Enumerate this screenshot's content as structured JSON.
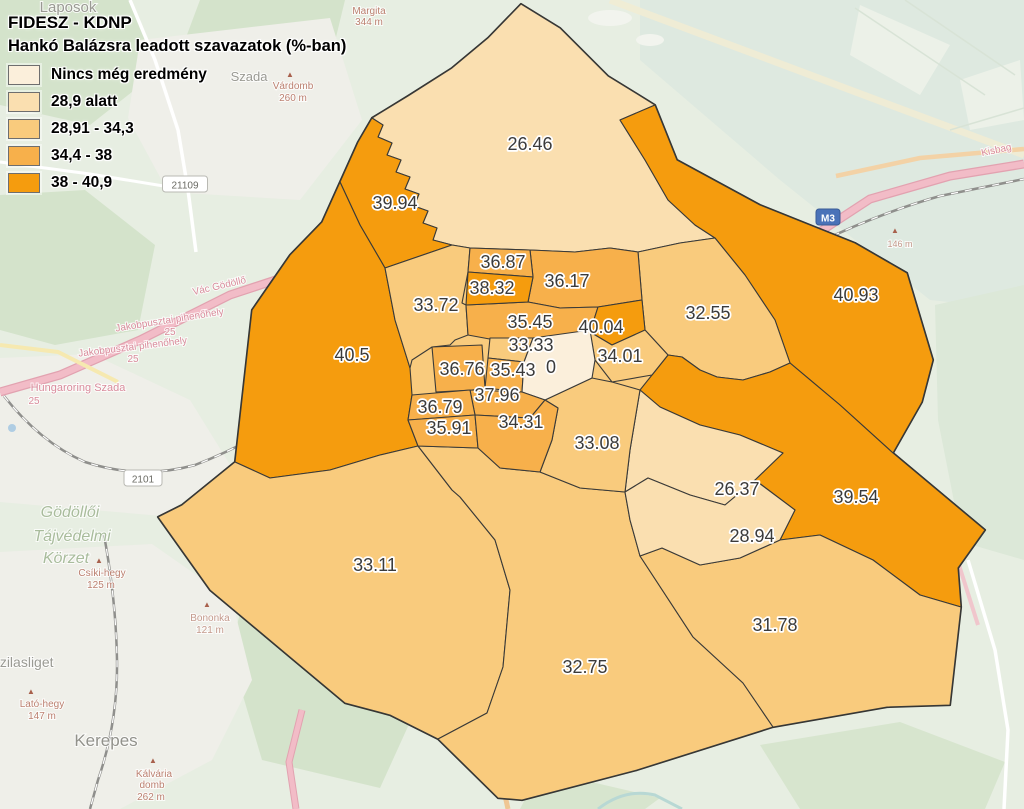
{
  "title": {
    "line1": "FIDESZ - KDNP",
    "line2": "Hankó Balázsra leadott szavazatok (%-ban)"
  },
  "legend": {
    "classes": [
      {
        "label": "Nincs még eredmény",
        "color": "#FBEFDB"
      },
      {
        "label": "28,9 alatt",
        "color": "#FADFB0"
      },
      {
        "label": "28,91 - 34,3",
        "color": "#F9CB7D"
      },
      {
        "label": "34,4 - 38",
        "color": "#F7B04B"
      },
      {
        "label": "38 - 40,9",
        "color": "#F59C0E"
      }
    ]
  },
  "map": {
    "border_color": "#3a3a38",
    "outline_color": "#2e2e2c",
    "districts": [
      {
        "value": "26.46",
        "class": 2,
        "x": 530,
        "y": 144
      },
      {
        "value": "40.93",
        "class": 5,
        "x": 856,
        "y": 295
      },
      {
        "value": "39.94",
        "class": 5,
        "x": 395,
        "y": 203
      },
      {
        "value": "40.5",
        "class": 5,
        "x": 352,
        "y": 355
      },
      {
        "value": "32.55",
        "class": 3,
        "x": 708,
        "y": 313
      },
      {
        "value": "33.72",
        "class": 3,
        "x": 436,
        "y": 305
      },
      {
        "value": "39.54",
        "class": 5,
        "x": 856,
        "y": 497
      },
      {
        "value": "33.11",
        "class": 3,
        "x": 375,
        "y": 565
      },
      {
        "value": "32.75",
        "class": 3,
        "x": 585,
        "y": 667
      },
      {
        "value": "31.78",
        "class": 3,
        "x": 775,
        "y": 625
      },
      {
        "value": "26.37",
        "class": 2,
        "x": 737,
        "y": 489
      },
      {
        "value": "28.94",
        "class": 2,
        "x": 752,
        "y": 536
      },
      {
        "value": "33.08",
        "class": 3,
        "x": 597,
        "y": 443
      },
      {
        "value": "36.17",
        "class": 4,
        "x": 567,
        "y": 281
      },
      {
        "value": "35.45",
        "class": 4,
        "x": 530,
        "y": 322
      },
      {
        "value": "36.87",
        "class": 4,
        "x": 503,
        "y": 262
      },
      {
        "value": "38.32",
        "class": 5,
        "x": 492,
        "y": 288
      },
      {
        "value": "40.04",
        "class": 5,
        "x": 601,
        "y": 327
      },
      {
        "value": "34.01",
        "class": 3,
        "x": 620,
        "y": 356
      },
      {
        "value": "33.33",
        "class": 3,
        "x": 531,
        "y": 345
      },
      {
        "value": "36.76",
        "class": 4,
        "x": 462,
        "y": 369
      },
      {
        "value": "35.43",
        "class": 4,
        "x": 513,
        "y": 370
      },
      {
        "value": "0",
        "class": 1,
        "x": 551,
        "y": 367
      },
      {
        "value": "37.96",
        "class": 4,
        "x": 497,
        "y": 395
      },
      {
        "value": "36.79",
        "class": 4,
        "x": 440,
        "y": 407
      },
      {
        "value": "35.91",
        "class": 4,
        "x": 449,
        "y": 428
      },
      {
        "value": "34.31",
        "class": 4,
        "x": 521,
        "y": 422
      }
    ]
  },
  "basemap": {
    "labels": [
      {
        "text": "Laposok",
        "x": 68,
        "y": 12,
        "size": 15,
        "color": "#9A9A93"
      },
      {
        "text": "Margita",
        "x": 369,
        "y": 14,
        "size": 10,
        "color": "#BC8070"
      },
      {
        "text": "344 m",
        "x": 369,
        "y": 25,
        "size": 10,
        "color": "#BC8070"
      },
      {
        "text": "Szada",
        "x": 249,
        "y": 81,
        "size": 13,
        "color": "#9A9A93"
      },
      {
        "text": "Várdomb",
        "x": 293,
        "y": 89,
        "size": 10,
        "color": "#BC8070"
      },
      {
        "text": "260 m",
        "x": 293,
        "y": 101,
        "size": 10,
        "color": "#BC8070"
      },
      {
        "text": "Vác Gödöllő",
        "x": 220,
        "y": 289,
        "size": 10,
        "color": "#D98C9C",
        "rot": -13
      },
      {
        "text": "Jakobpusztai pihenőhely",
        "x": 170,
        "y": 323,
        "size": 10,
        "color": "#D98C9C",
        "rot": -9
      },
      {
        "text": "25",
        "x": 170,
        "y": 335,
        "size": 10,
        "color": "#D98C9C"
      },
      {
        "text": "Jakobpusztai pihenőhely",
        "x": 133,
        "y": 350,
        "size": 10,
        "color": "#D98C9C",
        "rot": -7
      },
      {
        "text": "25",
        "x": 133,
        "y": 362,
        "size": 10,
        "color": "#D98C9C"
      },
      {
        "text": "Hungaroring Szada",
        "x": 78,
        "y": 391,
        "size": 11,
        "color": "#D98C9C"
      },
      {
        "text": "25",
        "x": 34,
        "y": 404,
        "size": 10,
        "color": "#D98C9C"
      },
      {
        "text": "Gödöllői",
        "x": 70,
        "y": 517,
        "size": 16,
        "color": "#A9BC9C",
        "italic": true
      },
      {
        "text": "Tájvédelmi",
        "x": 72,
        "y": 541,
        "size": 16,
        "color": "#A9BC9C",
        "italic": true
      },
      {
        "text": "Körzet",
        "x": 66,
        "y": 563,
        "size": 16,
        "color": "#A9BC9C",
        "italic": true
      },
      {
        "text": "Csíki-hegy",
        "x": 102,
        "y": 576,
        "size": 10,
        "color": "#BC8070"
      },
      {
        "text": "125 m",
        "x": 101,
        "y": 588,
        "size": 10,
        "color": "#BC8070"
      },
      {
        "text": "Bononka",
        "x": 210,
        "y": 621,
        "size": 10,
        "color": "#C49A8C"
      },
      {
        "text": "121 m",
        "x": 210,
        "y": 633,
        "size": 10,
        "color": "#C49A8C"
      },
      {
        "text": "Szilasliget",
        "x": 22,
        "y": 667,
        "size": 14,
        "color": "#9A9A93"
      },
      {
        "text": "Lató-hegy",
        "x": 42,
        "y": 707,
        "size": 10,
        "color": "#BC8070"
      },
      {
        "text": "147 m",
        "x": 42,
        "y": 719,
        "size": 10,
        "color": "#BC8070"
      },
      {
        "text": "Kerepes",
        "x": 106,
        "y": 746,
        "size": 17,
        "color": "#92928B"
      },
      {
        "text": "Kálvária",
        "x": 154,
        "y": 777,
        "size": 10,
        "color": "#BC8070"
      },
      {
        "text": "domb",
        "x": 152,
        "y": 788,
        "size": 10,
        "color": "#BC8070"
      },
      {
        "text": "262 m",
        "x": 151,
        "y": 800,
        "size": 10,
        "color": "#BC8070"
      },
      {
        "text": "Kisbag",
        "x": 997,
        "y": 153,
        "size": 10,
        "color": "#D98C9C",
        "rot": -12
      },
      {
        "text": "146 m",
        "x": 900,
        "y": 247,
        "size": 9,
        "color": "#C49A8C"
      }
    ],
    "peaks": [
      [
        290,
        77
      ],
      [
        99,
        563
      ],
      [
        207,
        607
      ],
      [
        31,
        694
      ],
      [
        153,
        763
      ],
      [
        895,
        233
      ]
    ],
    "shields": [
      {
        "text": "21109",
        "x": 185,
        "y": 185,
        "style": "white"
      },
      {
        "text": "2101",
        "x": 143,
        "y": 479,
        "style": "white"
      },
      {
        "text": "M3",
        "x": 828,
        "y": 218,
        "style": "blue"
      }
    ]
  }
}
